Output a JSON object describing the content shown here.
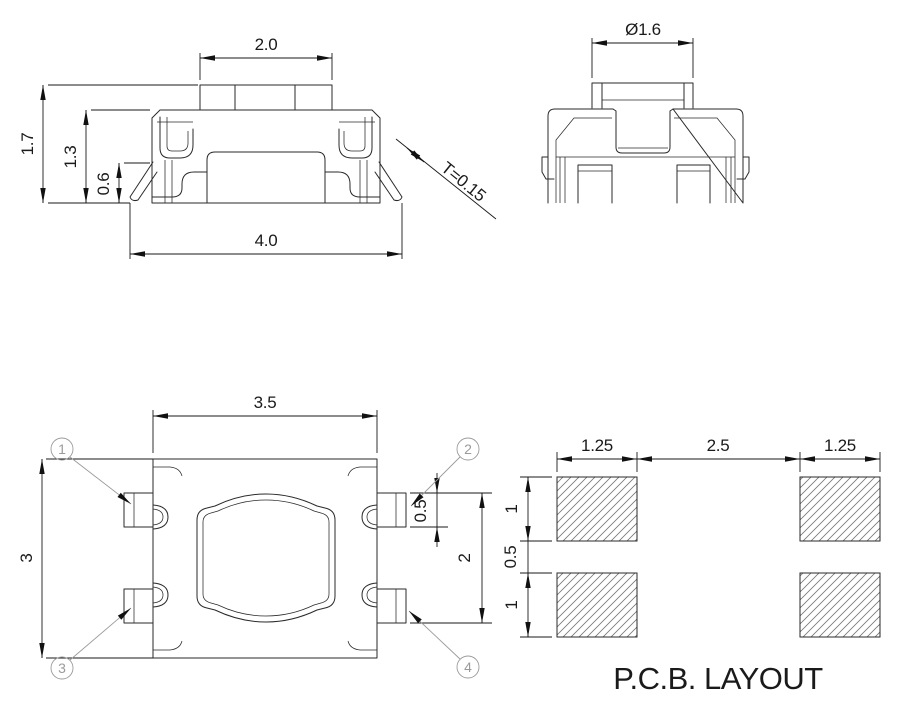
{
  "drawing": {
    "type": "SMD tactile switch dimensional drawing",
    "colors": {
      "line": "#2a2a2a",
      "dim": "#1a1a1a",
      "leader": "#9b9b9b",
      "background": "#ffffff",
      "hatch": "#777777"
    }
  },
  "front_view": {
    "top_width": "2.0",
    "total_height": "1.7",
    "body_height": "1.3",
    "terminal_height": "0.6",
    "total_width": "4.0",
    "thickness": "T=0.15"
  },
  "side_view": {
    "button_diameter": "Ø1.6"
  },
  "top_view": {
    "body_width": "3.5",
    "body_depth": "3",
    "terminal_width": "0.5",
    "terminal_span": "2",
    "callouts": [
      "1",
      "2",
      "3",
      "4"
    ]
  },
  "pcb_layout": {
    "title": "P.C.B. LAYOUT",
    "pad_width_left": "1.25",
    "pad_gap": "2.5",
    "pad_width_right": "1.25",
    "pad_height_top": "1",
    "row_gap": "0.5",
    "pad_height_bottom": "1"
  }
}
